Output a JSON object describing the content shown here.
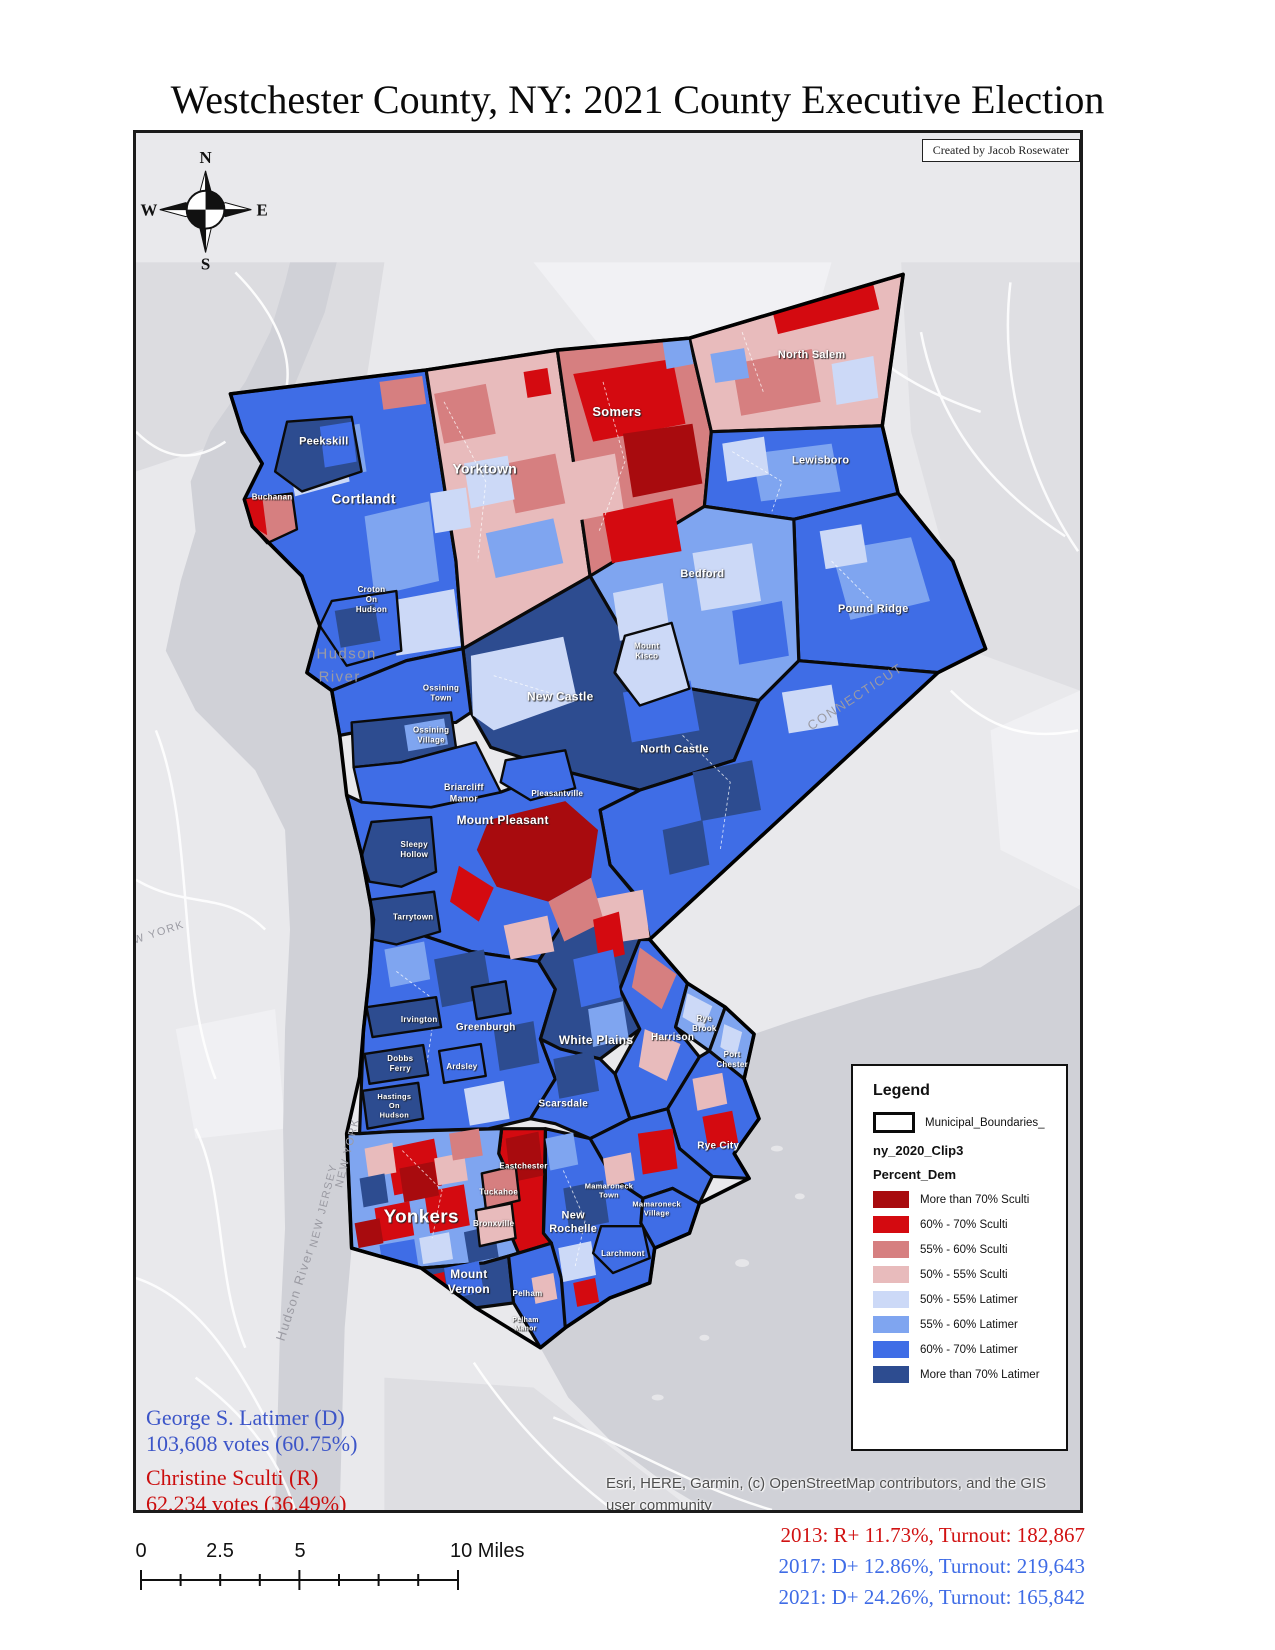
{
  "title": "Westchester County, NY: 2021 County Executive Election",
  "credit": "Created by Jacob Rosewater",
  "compass": {
    "n": "N",
    "e": "E",
    "s": "S",
    "w": "W"
  },
  "legend": {
    "title": "Legend",
    "boundary_label": "Municipal_Boundaries_",
    "layer_label": "ny_2020_Clip3",
    "field_label": "Percent_Dem",
    "items": [
      {
        "label": "More than 70% Sculti",
        "color": "#a80b0e"
      },
      {
        "label": "60% - 70% Sculti",
        "color": "#d40a10"
      },
      {
        "label": "55% - 60% Sculti",
        "color": "#d67f80"
      },
      {
        "label": "50% - 55% Sculti",
        "color": "#e8bbbc"
      },
      {
        "label": "50% - 55% Latimer",
        "color": "#ccd9f7"
      },
      {
        "label": "55% - 60% Latimer",
        "color": "#7fa5f0"
      },
      {
        "label": "60% - 70% Latimer",
        "color": "#3f6de6"
      },
      {
        "label": "More than 70% Latimer",
        "color": "#2d4c90"
      }
    ]
  },
  "results": {
    "democrat": {
      "name": "George S. Latimer (D)",
      "votes": "103,608 votes (60.75%)",
      "color": "#3c55c8"
    },
    "republican": {
      "name": "Christine Sculti (R)",
      "votes": "62,234 votes (36.49%)",
      "color": "#cb0e0e"
    }
  },
  "attribution": {
    "line1": "Esri, HERE, Garmin, (c) OpenStreetMap contributors, and the GIS",
    "line2": "user community"
  },
  "scalebar": {
    "labels": [
      {
        "text": "0",
        "x": 8,
        "anchor": "center"
      },
      {
        "text": "2.5",
        "x": 87,
        "anchor": "center"
      },
      {
        "text": "5",
        "x": 167,
        "anchor": "center"
      },
      {
        "text": "10 Miles",
        "x": 317,
        "anchor": "left"
      }
    ]
  },
  "history": [
    {
      "text": "2013: R+ 11.73%, Turnout: 182,867",
      "color": "#d11212"
    },
    {
      "text": "2017: D+ 12.86%, Turnout: 219,643",
      "color": "#3f6ce6"
    },
    {
      "text": "2021: D+ 24.26%, Turnout: 165,842",
      "color": "#3f6ce6"
    }
  ],
  "map": {
    "municipality_labels": [
      {
        "slug": "peekskill",
        "lines": [
          "Peekskill"
        ],
        "x": 189,
        "y": 313,
        "size": 11
      },
      {
        "slug": "buchanan",
        "lines": [
          "Buchanan"
        ],
        "x": 137,
        "y": 368,
        "size": 8
      },
      {
        "slug": "cortlandt",
        "lines": [
          "Cortlandt"
        ],
        "x": 229,
        "y": 372,
        "size": 14
      },
      {
        "slug": "yorktown",
        "lines": [
          "Yorktown"
        ],
        "x": 351,
        "y": 342,
        "size": 14
      },
      {
        "slug": "somers",
        "lines": [
          "Somers"
        ],
        "x": 484,
        "y": 284,
        "size": 13
      },
      {
        "slug": "north-salem",
        "lines": [
          "North Salem"
        ],
        "x": 680,
        "y": 226,
        "size": 11
      },
      {
        "slug": "lewisboro",
        "lines": [
          "Lewisboro"
        ],
        "x": 689,
        "y": 332,
        "size": 11
      },
      {
        "slug": "bedford",
        "lines": [
          "Bedford"
        ],
        "x": 570,
        "y": 446,
        "size": 11
      },
      {
        "slug": "pound-ridge",
        "lines": [
          "Pound Ridge"
        ],
        "x": 742,
        "y": 481,
        "size": 11
      },
      {
        "slug": "croton-on-hudson",
        "lines": [
          "Croton",
          "On",
          "Hudson"
        ],
        "x": 237,
        "y": 461,
        "size": 8
      },
      {
        "slug": "mount-kisco",
        "lines": [
          "Mount",
          "Kisco"
        ],
        "x": 514,
        "y": 518,
        "size": 8
      },
      {
        "slug": "ossining-town",
        "lines": [
          "Ossining",
          "Town"
        ],
        "x": 307,
        "y": 560,
        "size": 8
      },
      {
        "slug": "ossining-village",
        "lines": [
          "Ossining",
          "Village"
        ],
        "x": 297,
        "y": 602,
        "size": 8
      },
      {
        "slug": "new-castle",
        "lines": [
          "New Castle"
        ],
        "x": 427,
        "y": 570,
        "size": 12
      },
      {
        "slug": "north-castle",
        "lines": [
          "North Castle"
        ],
        "x": 542,
        "y": 622,
        "size": 11
      },
      {
        "slug": "briarcliff-manor",
        "lines": [
          "Briarcliff",
          "Manor"
        ],
        "x": 330,
        "y": 660,
        "size": 9
      },
      {
        "slug": "pleasantville",
        "lines": [
          "Pleasantville"
        ],
        "x": 424,
        "y": 666,
        "size": 8
      },
      {
        "slug": "mount-pleasant",
        "lines": [
          "Mount Pleasant"
        ],
        "x": 369,
        "y": 694,
        "size": 12
      },
      {
        "slug": "sleepy-hollow",
        "lines": [
          "Sleepy",
          "Hollow"
        ],
        "x": 280,
        "y": 717,
        "size": 8
      },
      {
        "slug": "tarrytown",
        "lines": [
          "Tarrytown"
        ],
        "x": 279,
        "y": 790,
        "size": 8
      },
      {
        "slug": "irvington",
        "lines": [
          "Irvington"
        ],
        "x": 285,
        "y": 893,
        "size": 8
      },
      {
        "slug": "greenburgh",
        "lines": [
          "Greenburgh"
        ],
        "x": 352,
        "y": 901,
        "size": 10
      },
      {
        "slug": "white-plains",
        "lines": [
          "White Plains"
        ],
        "x": 463,
        "y": 915,
        "size": 12
      },
      {
        "slug": "harrison",
        "lines": [
          "Harrison"
        ],
        "x": 540,
        "y": 911,
        "size": 10
      },
      {
        "slug": "rye-brook",
        "lines": [
          "Rye",
          "Brook"
        ],
        "x": 572,
        "y": 892,
        "size": 8
      },
      {
        "slug": "port-chester",
        "lines": [
          "Port",
          "Chester"
        ],
        "x": 600,
        "y": 928,
        "size": 8
      },
      {
        "slug": "dobbs-ferry",
        "lines": [
          "Dobbs",
          "Ferry"
        ],
        "x": 266,
        "y": 932,
        "size": 8
      },
      {
        "slug": "ardsley",
        "lines": [
          "Ardsley"
        ],
        "x": 328,
        "y": 940,
        "size": 8
      },
      {
        "slug": "hastings-on-hudson",
        "lines": [
          "Hastings",
          "On",
          "Hudson"
        ],
        "x": 260,
        "y": 970,
        "size": 7.5
      },
      {
        "slug": "scarsdale",
        "lines": [
          "Scarsdale"
        ],
        "x": 430,
        "y": 978,
        "size": 10
      },
      {
        "slug": "rye-city",
        "lines": [
          "Rye City"
        ],
        "x": 586,
        "y": 1020,
        "size": 10
      },
      {
        "slug": "eastchester",
        "lines": [
          "Eastchester"
        ],
        "x": 390,
        "y": 1040,
        "size": 8
      },
      {
        "slug": "tuckahoe",
        "lines": [
          "Tuckahoe"
        ],
        "x": 365,
        "y": 1066,
        "size": 8
      },
      {
        "slug": "bronxville",
        "lines": [
          "Bronxville"
        ],
        "x": 360,
        "y": 1098,
        "size": 8
      },
      {
        "slug": "yonkers",
        "lines": [
          "Yonkers"
        ],
        "x": 287,
        "y": 1094,
        "size": 19
      },
      {
        "slug": "new-rochelle",
        "lines": [
          "New",
          "Rochelle"
        ],
        "x": 440,
        "y": 1090,
        "size": 11
      },
      {
        "slug": "mamaroneck-town",
        "lines": [
          "Mamaroneck",
          "Town"
        ],
        "x": 476,
        "y": 1060,
        "size": 7.5
      },
      {
        "slug": "mamaroneck-village",
        "lines": [
          "Mamaroneck",
          "Village"
        ],
        "x": 524,
        "y": 1078,
        "size": 7.5
      },
      {
        "slug": "larchmont",
        "lines": [
          "Larchmont"
        ],
        "x": 490,
        "y": 1128,
        "size": 8
      },
      {
        "slug": "mount-vernon",
        "lines": [
          "Mount",
          "Vernon"
        ],
        "x": 335,
        "y": 1150,
        "size": 12
      },
      {
        "slug": "pelham",
        "lines": [
          "Pelham"
        ],
        "x": 394,
        "y": 1168,
        "size": 8
      },
      {
        "slug": "pelham-manor",
        "lines": [
          "Pelham",
          "Manor"
        ],
        "x": 392,
        "y": 1194,
        "size": 7
      }
    ],
    "geo_labels": [
      {
        "text": "Hudson",
        "x": 212,
        "y": 528,
        "size": 15,
        "rot": 0,
        "color": "#a3a3ab"
      },
      {
        "text": "River",
        "x": 205,
        "y": 551,
        "size": 15,
        "rot": 0,
        "color": "#a3a3ab"
      },
      {
        "text": "W YORK",
        "x": 24,
        "y": 806,
        "size": 11,
        "rot": -18,
        "color": "#a8a8b0"
      },
      {
        "text": "NEW YORK",
        "x": 216,
        "y": 1025,
        "size": 11,
        "rot": -76,
        "color": "#a8a8b0"
      },
      {
        "text": "NEW JERSEY",
        "x": 192,
        "y": 1078,
        "size": 11,
        "rot": -76,
        "color": "#a8a8b0"
      },
      {
        "text": "Hudson River",
        "x": 164,
        "y": 1168,
        "size": 13,
        "rot": -72,
        "color": "#9b9ba3"
      },
      {
        "text": "CONNECTICUT",
        "x": 726,
        "y": 570,
        "size": 13,
        "rot": -33,
        "color": "#b4b4bc"
      }
    ]
  }
}
